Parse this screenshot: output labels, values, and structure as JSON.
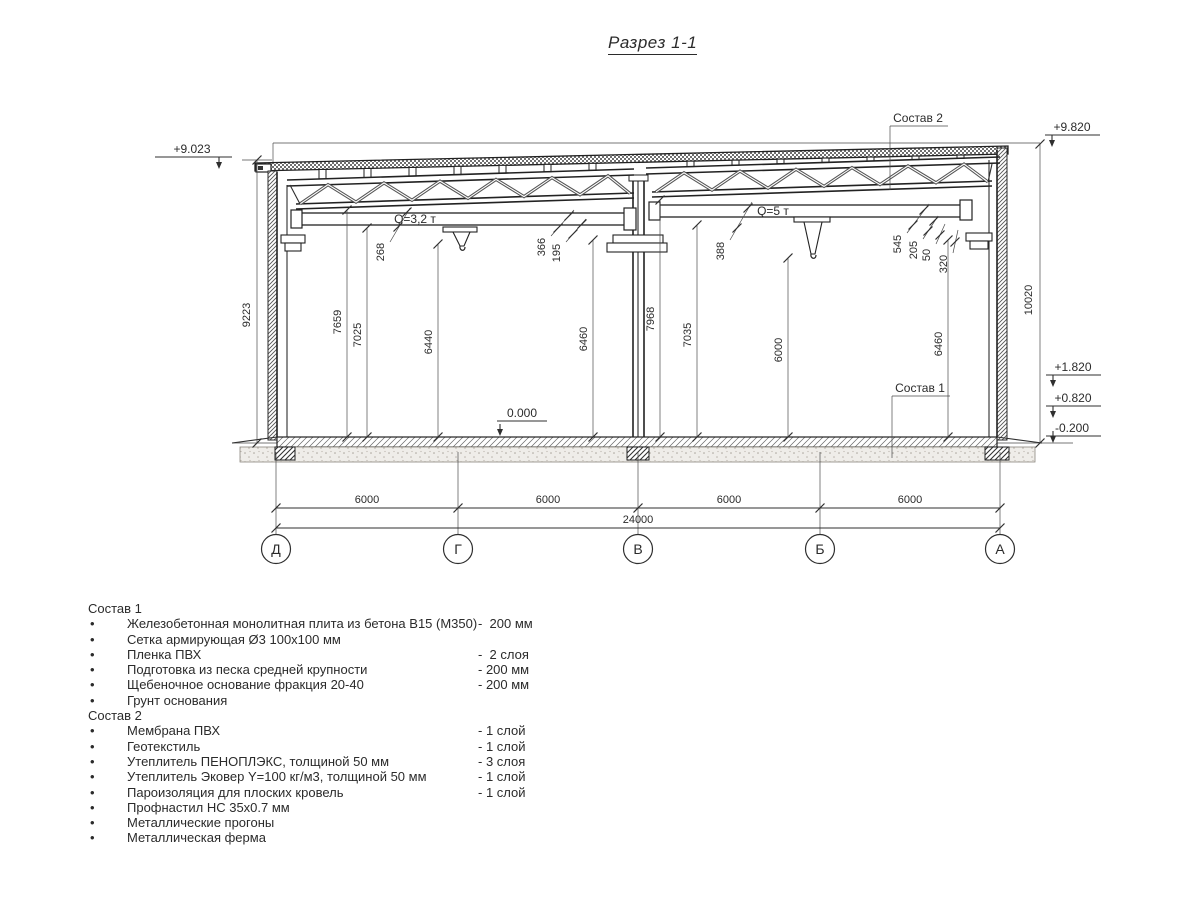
{
  "title": "Разрез 1-1",
  "drawing": {
    "elevations": {
      "left_top": "+9.023",
      "right_top": "+9.820",
      "right_upper": "+1.820",
      "right_lower": "+0.820",
      "right_ground": "-0.200",
      "floor": "0.000"
    },
    "crane": {
      "left": "Q=3,2 т",
      "right": "Q=5 т"
    },
    "comp_labels": {
      "roof": "Состав 2",
      "floor": "Состав 1"
    },
    "dims": {
      "wall_left": "9223",
      "wall_right": "10020",
      "d268": "268",
      "d7659": "7659",
      "d7025": "7025",
      "d6440": "6440",
      "d366": "366",
      "d195": "195",
      "d6460l": "6460",
      "d388": "388",
      "d7968": "7968",
      "d7035": "7035",
      "d6000": "6000",
      "d545": "545",
      "d205": "205",
      "d50": "50",
      "d320": "320",
      "d6460r": "6460",
      "span1": "6000",
      "span2": "6000",
      "span3": "6000",
      "span4": "6000",
      "total": "24000"
    },
    "axes": [
      "Д",
      "Г",
      "В",
      "Б",
      "А"
    ]
  },
  "notes": {
    "bullet": "•",
    "group1": {
      "title": "Состав 1",
      "items": [
        {
          "text": "Железобетонная монолитная плита из бетона В15 (М350)",
          "value": "-  200 мм"
        },
        {
          "text": "Сетка армирующая Ø3 100х100 мм",
          "value": ""
        },
        {
          "text": "Пленка ПВХ",
          "value": "-  2 слоя"
        },
        {
          "text": "Подготовка из песка средней крупности",
          "value": "- 200 мм"
        },
        {
          "text": "Щебеночное основание фракция 20-40",
          "value": "- 200 мм"
        },
        {
          "text": "Грунт основания",
          "value": ""
        }
      ]
    },
    "group2": {
      "title": "Состав 2",
      "items": [
        {
          "text": "Мембрана ПВХ",
          "value": "- 1 слой"
        },
        {
          "text": "Геотекстиль",
          "value": "- 1 слой"
        },
        {
          "text": "Утеплитель ПЕНОПЛЭКС, толщиной 50 мм",
          "value": "- 3 слоя"
        },
        {
          "text": "Утеплитель Эковер Y=100 кг/м3, толщиной 50 мм",
          "value": "- 1 слой"
        },
        {
          "text": "Пароизоляция для плоских кровель",
          "value": "- 1 слой"
        },
        {
          "text": "Профнастил НС 35х0.7 мм",
          "value": ""
        },
        {
          "text": "Металлические прогоны",
          "value": ""
        },
        {
          "text": "Металлическая ферма",
          "value": ""
        }
      ]
    }
  }
}
